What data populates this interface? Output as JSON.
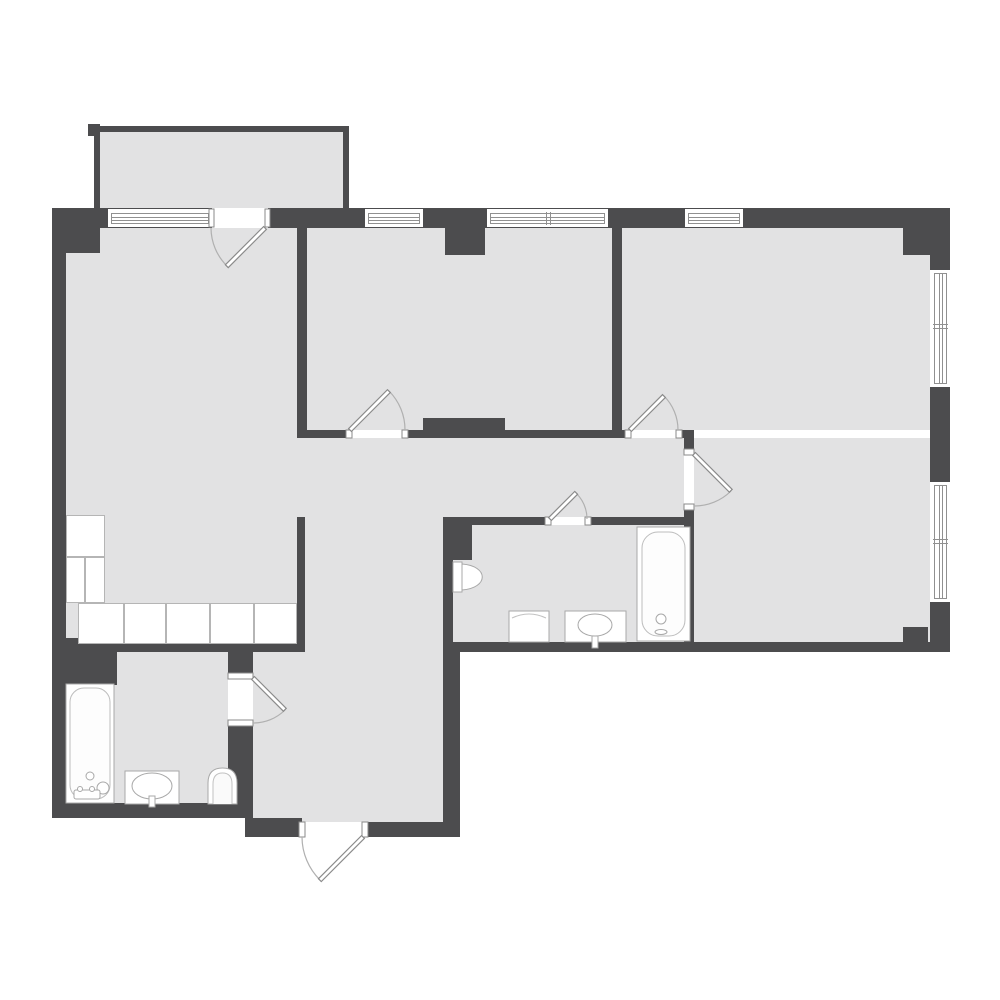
{
  "title": "apartment-floor-plan",
  "colors": {
    "background": "#ffffff",
    "wall": "#4c4c4e",
    "floor": "#e2e2e3",
    "window_line": "#909090",
    "fixture_outline": "#a8a8a8",
    "fixture_fill": "#ffffff",
    "counter_line": "#b5b5b5",
    "door_stroke": "#8a8a8a"
  },
  "rooms": [
    {
      "name": "balcony"
    },
    {
      "name": "living-room-kitchen"
    },
    {
      "name": "bedroom-top-middle"
    },
    {
      "name": "bedroom-top-right"
    },
    {
      "name": "bedroom-bottom-right"
    },
    {
      "name": "corridor"
    },
    {
      "name": "hallway"
    },
    {
      "name": "bathroom-middle"
    },
    {
      "name": "bathroom-bottom-left"
    }
  ],
  "windows": [
    {
      "name": "window-top-left"
    },
    {
      "name": "window-top-middle-small"
    },
    {
      "name": "window-top-middle-double"
    },
    {
      "name": "window-top-right"
    },
    {
      "name": "window-right-upper"
    },
    {
      "name": "window-right-lower"
    }
  ],
  "doors": [
    {
      "name": "balcony-door"
    },
    {
      "name": "bedroom-top-middle-door"
    },
    {
      "name": "bedroom-top-right-door"
    },
    {
      "name": "bathroom-middle-door"
    },
    {
      "name": "bedroom-bottom-right-door"
    },
    {
      "name": "bathroom-bottom-left-door"
    },
    {
      "name": "entrance-door"
    }
  ],
  "fixtures": [
    {
      "name": "bathtub-middle"
    },
    {
      "name": "sink-middle"
    },
    {
      "name": "washing-machine"
    },
    {
      "name": "toilet-middle"
    },
    {
      "name": "bathtub-bottom-left"
    },
    {
      "name": "sink-bottom-left"
    },
    {
      "name": "toilet-bottom-left"
    },
    {
      "name": "kitchen-counter"
    }
  ]
}
